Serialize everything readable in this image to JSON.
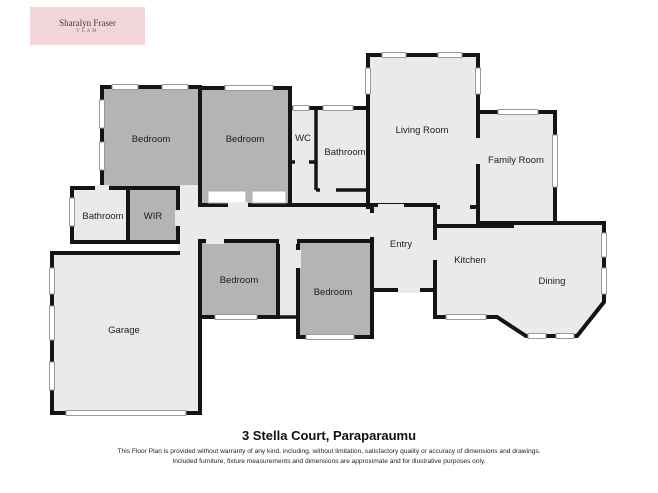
{
  "brand": {
    "name": "Sharalyn Fraser",
    "subtitle": "TEAM"
  },
  "title": "3 Stella Court, Paraparaumu",
  "disclaimer": {
    "line1": "This Floor Plan is provided without warranty of any kind, including, without limitation, satisfactory quality or accuracy of dimensions and drawings.",
    "line2": "Included furniture, fixture measurements and dimensions are approximate and for illustrative purposes only."
  },
  "rooms": [
    {
      "id": "bedroom-1",
      "label": "Bedroom"
    },
    {
      "id": "bedroom-2",
      "label": "Bedroom"
    },
    {
      "id": "wc",
      "label": "WC"
    },
    {
      "id": "bathroom-1",
      "label": "Bathroom"
    },
    {
      "id": "living-room",
      "label": "Living Room"
    },
    {
      "id": "family-room",
      "label": "Family Room"
    },
    {
      "id": "bathroom-2",
      "label": "Bathroom"
    },
    {
      "id": "wir",
      "label": "WIR"
    },
    {
      "id": "entry",
      "label": "Entry"
    },
    {
      "id": "kitchen",
      "label": "Kitchen"
    },
    {
      "id": "dining",
      "label": "Dining"
    },
    {
      "id": "bedroom-3",
      "label": "Bedroom"
    },
    {
      "id": "bedroom-4",
      "label": "Bedroom"
    },
    {
      "id": "garage",
      "label": "Garage"
    }
  ],
  "colors": {
    "wall": "#141414",
    "room_light": "#eaeaea",
    "room_dark": "#b4b4b4",
    "window_line": "#9a9a9a",
    "logo_background": "#f2d5d9",
    "page_background": "#ffffff"
  }
}
